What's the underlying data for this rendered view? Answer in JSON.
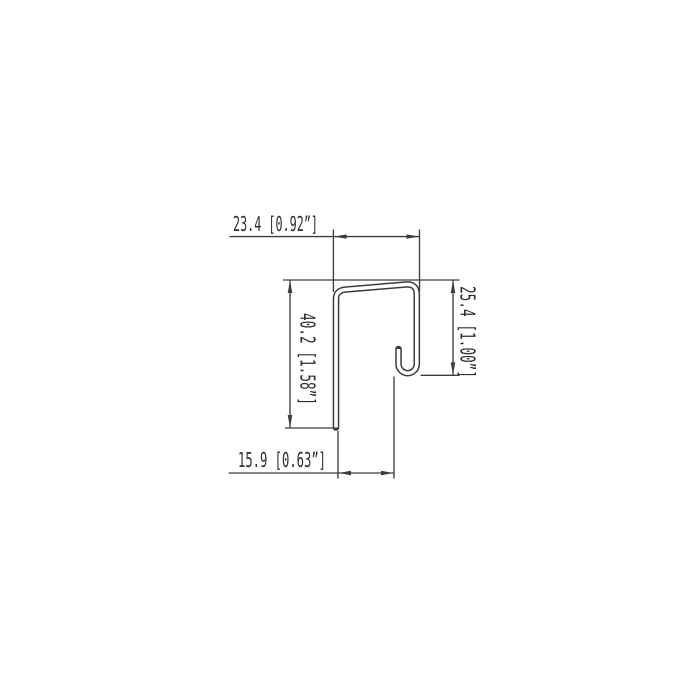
{
  "drawing": {
    "dimensions": {
      "top_width": "23.4 [0.92”]",
      "left_height": "40.2 [1.58”]",
      "right_height": "25.4 [1.00”]",
      "bottom_width": "15.9 [0.63”]"
    },
    "colors": {
      "line": "#3c3c3c",
      "text": "#2f2f2f",
      "background": "#ffffff"
    }
  }
}
